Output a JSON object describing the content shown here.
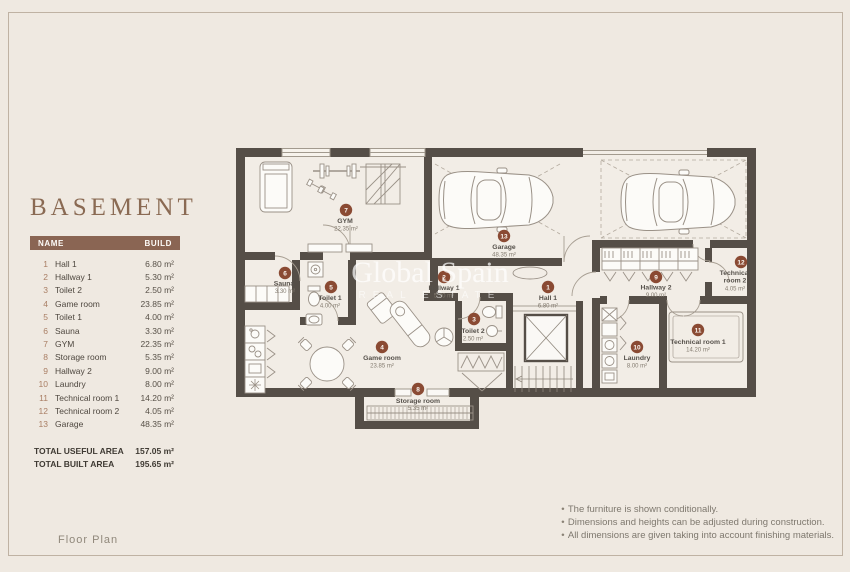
{
  "title": "BASEMENT",
  "table": {
    "name_header": "NAME",
    "build_header": "BUILD"
  },
  "rooms": [
    {
      "num": "1",
      "name": "Hall 1",
      "area": "6.80 m²"
    },
    {
      "num": "2",
      "name": "Hallway 1",
      "area": "5.30 m²"
    },
    {
      "num": "3",
      "name": "Toilet 2",
      "area": "2.50 m²"
    },
    {
      "num": "4",
      "name": "Game room",
      "area": "23.85 m²"
    },
    {
      "num": "5",
      "name": "Toilet 1",
      "area": "4.00 m²"
    },
    {
      "num": "6",
      "name": "Sauna",
      "area": "3.30 m²"
    },
    {
      "num": "7",
      "name": "GYM",
      "area": "22.35 m²"
    },
    {
      "num": "8",
      "name": "Storage room",
      "area": "5.35 m²"
    },
    {
      "num": "9",
      "name": "Hallway 2",
      "area": "9.00 m²"
    },
    {
      "num": "10",
      "name": "Laundry",
      "area": "8.00 m²"
    },
    {
      "num": "11",
      "name": "Technical room 1",
      "area": "14.20 m²"
    },
    {
      "num": "12",
      "name": "Technical room 2",
      "name_line1": "Technical",
      "name_line2": "room 2",
      "area": "4.05 m²"
    },
    {
      "num": "13",
      "name": "Garage",
      "area": "48.35 m²"
    }
  ],
  "totals": {
    "useful_label": "TOTAL USEFUL AREA",
    "useful_value": "157.05 m²",
    "built_label": "TOTAL BUILT AREA",
    "built_value": "195.65 m²"
  },
  "footer": {
    "floor_plan_label": "Floor Plan"
  },
  "notes_bullet": "•",
  "notes": [
    "The furniture is shown conditionally.",
    "Dimensions and heights can be adjusted during construction.",
    "All dimensions are given taking into account finishing materials."
  ],
  "watermark": {
    "line1": "Global Spain",
    "line2": "REAL ESTATE"
  },
  "colors": {
    "background": "#EFE9E1",
    "wall": "#554E47",
    "accent_brown": "#8A6553",
    "badge": "#8A4A33"
  }
}
